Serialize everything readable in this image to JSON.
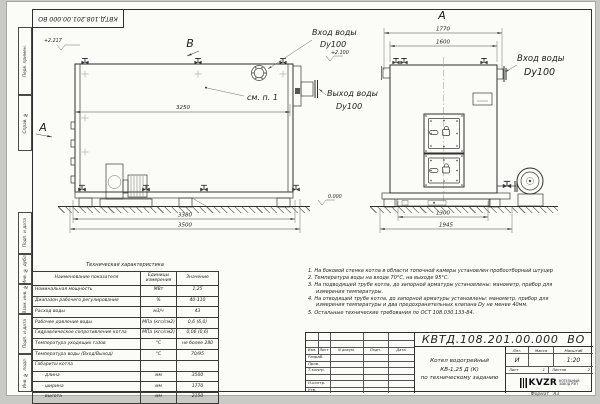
{
  "doc": {
    "stamp_rotated": "КВТД.108.201.00.000  ВО"
  },
  "frame": {
    "side_labels": [
      "Перв. примен.",
      "Справ. №",
      "Подп. и дата",
      "Инв. № дубл.",
      "Взам. инв. №",
      "Подп. и дата",
      "Инв. № подл."
    ]
  },
  "side_view": {
    "view_b": "B",
    "view_a": "A",
    "elev_top": "+2.217",
    "elev_inlet": "+2.100",
    "inlet_label": "Вход воды",
    "inlet_dn": "Dy100",
    "outlet_label": "Выход воды",
    "outlet_dn": "Dy100",
    "see_item": "см. п. 1",
    "dim_3250": "3250",
    "dim_3380": "3380",
    "dim_3500": "3500"
  },
  "front_view": {
    "title": "A",
    "dim_1770": "1770",
    "dim_1600": "1600",
    "dim_1300": "1300",
    "dim_1945": "1945",
    "elev_zero": "0.000",
    "inlet_label": "Вход воды",
    "inlet_dn": "Dy100"
  },
  "tech_table": {
    "title": "Техническая характеристика",
    "headers": [
      "Наименование показателя",
      "Единицы измерения",
      "Значение"
    ],
    "rows": [
      {
        "n": "Номинальная мощность",
        "u": "МВт",
        "v": "1,25"
      },
      {
        "n": "Диапазон рабочего регулирования",
        "u": "%",
        "v": "40-110"
      },
      {
        "n": "Расход воды",
        "u": "м3/ч",
        "v": "43"
      },
      {
        "n": "Рабочее давление воды",
        "u": "МПа (кгс/см2)",
        "v": "0,6 (6,0)"
      },
      {
        "n": "Гидравлическое сопротивление котла",
        "u": "МПа (кгс/см2)",
        "v": "0,06 (0,6)"
      },
      {
        "n": "Температура уходящих газов",
        "u": "°С",
        "v": "не более 280"
      },
      {
        "n": "Температура воды (Вход/Выход)",
        "u": "°С",
        "v": "70/95"
      },
      {
        "n": "Габариты котла",
        "u": "",
        "v": ""
      },
      {
        "n": "- длина",
        "u": "мм",
        "v": "3500"
      },
      {
        "n": "- ширина",
        "u": "мм",
        "v": "1770"
      },
      {
        "n": "- высота",
        "u": "мм",
        "v": "2150"
      }
    ]
  },
  "notes": {
    "items": [
      "1.  На боковой стенке котла в области топочной камеры установлен пробоотборный штуцер",
      "2.  Температура воды на входе 70°С, на выходе 95°С.",
      "3.  На подводящей трубе котла, до запорной арматуры установлены: манометр, прибор для измерения температуры.",
      "4.  На отводящей трубе котла, до запорной арматуры установлены: манометр, прибор для измерения температуры и два предохранительных клапана Dy не менее 40мм.",
      "5.  Остальные технические требования по ОСТ 108.030.133-84."
    ]
  },
  "title_block": {
    "doc_number": "КВТД.108.201.00.000  ВО",
    "name_line1": "Котел водогрейный",
    "name_line2": "КВ-1,25 Д (К)",
    "name_line3": "по техническому заданию",
    "lit_header": "Лит.",
    "mass_header": "Масса",
    "scale_header": "Масштаб",
    "lit_value": "И",
    "mass_value": "",
    "scale_value": "1:20",
    "sheet_label": "Лист",
    "sheet_value": "1",
    "sheets_label": "Листов",
    "sheets_value": "2",
    "cols": [
      "Изм.",
      "Лист",
      "N докум.",
      "Подп.",
      "Дата"
    ],
    "rows": [
      "Разраб.",
      "Пров.",
      "Т.контр.",
      "",
      "Н.контр.",
      "Утв."
    ],
    "logo_text": "KVZR",
    "logo_sub1": "КОТЕЛЬНЫЙ",
    "logo_sub2": "ЗАВОД РЭП",
    "format_label": "Формат",
    "format_value": "А3"
  }
}
